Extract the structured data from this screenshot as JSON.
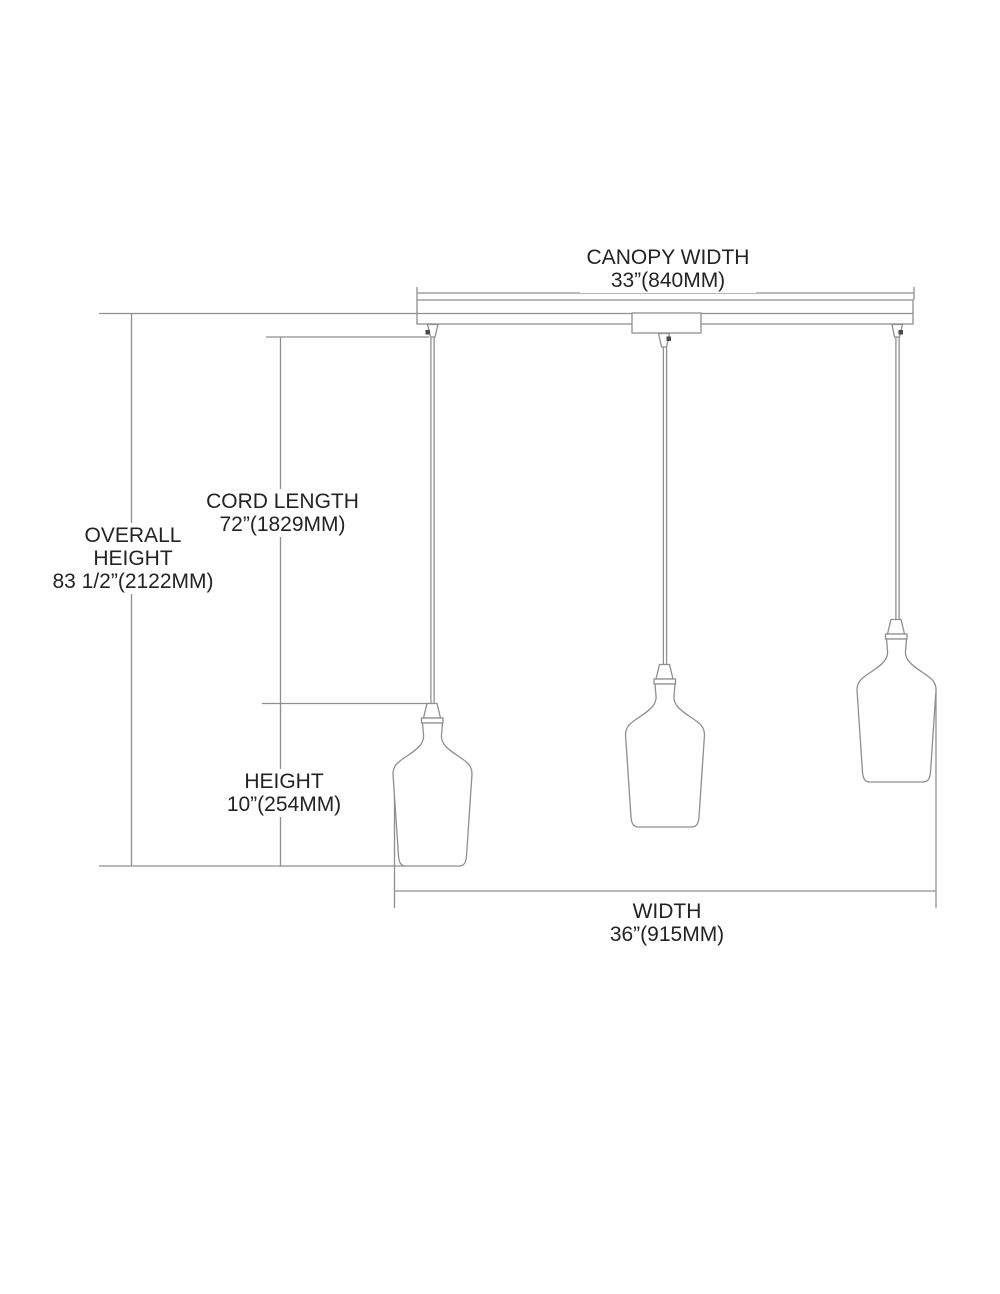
{
  "diagram": {
    "kind": "pendant-light-fixture-dimension-drawing",
    "pendant_count": 3,
    "colors": {
      "background": "#ffffff",
      "line": "#8f8f8f",
      "text": "#232323",
      "screw_dot": "#4a4a4a"
    },
    "labels": {
      "canopy_width": {
        "title": "CANOPY WIDTH",
        "value": "33”(840MM)"
      },
      "cord_length": {
        "title": "CORD LENGTH",
        "value": "72”(1829MM)"
      },
      "overall_height": {
        "title_line1": "OVERALL",
        "title_line2": "HEIGHT",
        "value": "83 1/2”(2122MM)"
      },
      "fixture_height": {
        "title": "HEIGHT",
        "value": "10”(254MM)"
      },
      "fixture_width": {
        "title": "WIDTH",
        "value": "36”(915MM)"
      }
    }
  }
}
